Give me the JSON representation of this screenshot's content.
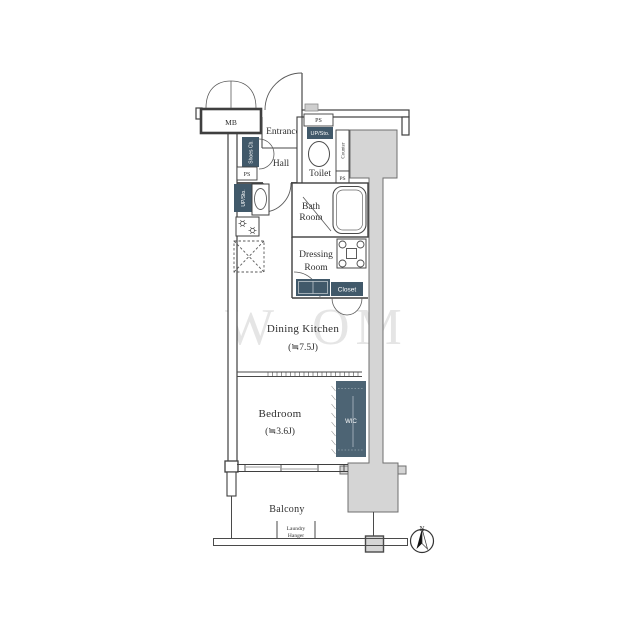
{
  "document_type": "apartment-floor-plan",
  "colors": {
    "badge_slate": "#41596a",
    "wic_slate": "#4d6474",
    "structure_gray": "#d5d5d5",
    "line_dark": "#3f3f3f",
    "watermark_gray": "#93a2ac"
  },
  "rooms": {
    "entrance": "Entrance",
    "hall": "Hall",
    "toilet": "Toilet",
    "bath_line1": "Bath",
    "bath_line2": "Room",
    "dressing_line1": "Dressing",
    "dressing_line2": "Room",
    "dining_kitchen_name": "Dining Kitchen",
    "dining_kitchen_size": "(≒7.5J)",
    "bedroom_name": "Bedroom",
    "bedroom_size": "(≒3.6J)",
    "balcony": "Balcony"
  },
  "labels": {
    "mb": "MB",
    "ps": "PS",
    "up_sto": "UP/Sto.",
    "shoes_cab": "Shoes Cb.",
    "counter": "Counter",
    "closet": "Closet",
    "wic": "WIC",
    "laundry_line1": "Laundry",
    "laundry_line2": "Hanger",
    "compass_north": "N"
  },
  "watermark": {
    "left": "W",
    "right": "OM"
  }
}
